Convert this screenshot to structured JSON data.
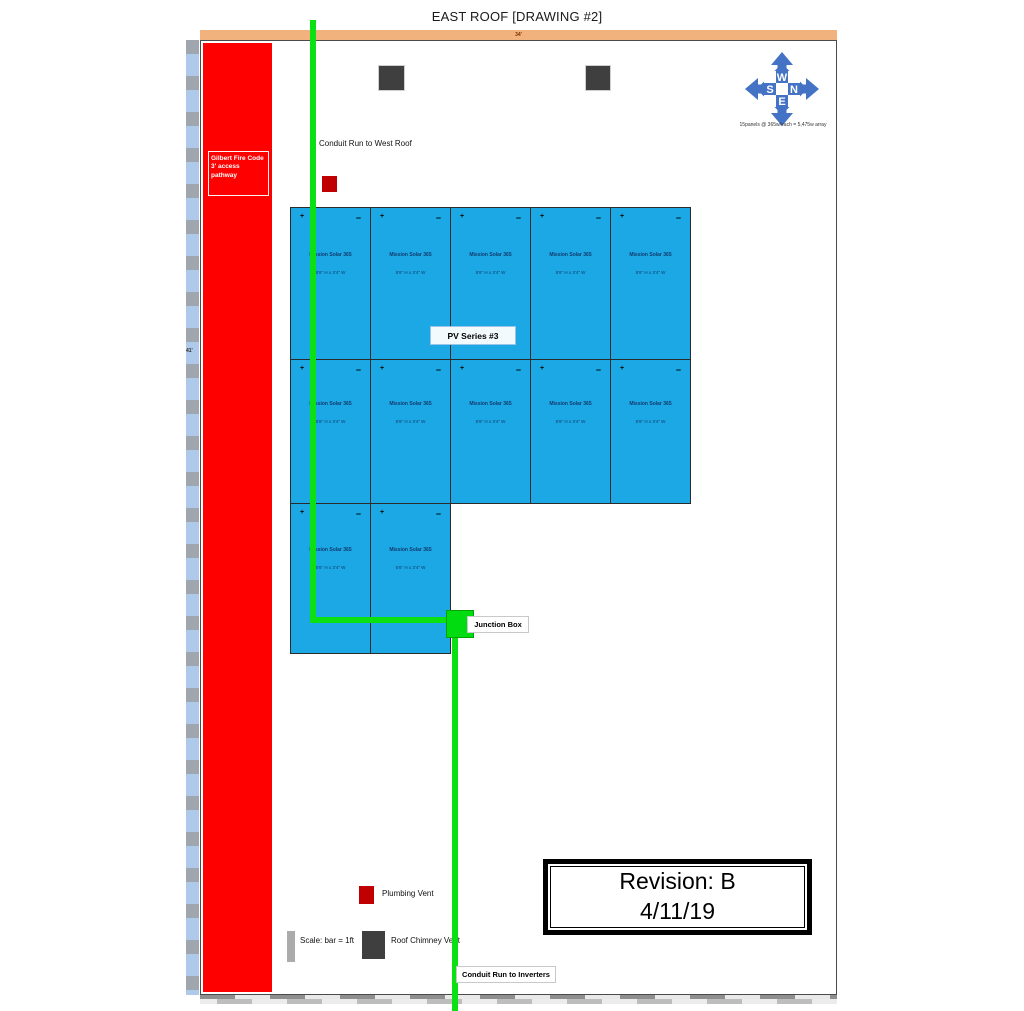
{
  "title": "EAST ROOF [DRAWING #2]",
  "dimensions": {
    "top_width": "34'",
    "left_height": "41'"
  },
  "fire_pathway": {
    "line1": "Gilbert Fire Code",
    "line2": "3' access",
    "line3": "pathway"
  },
  "compass": {
    "top": "W",
    "right": "N",
    "bottom": "E",
    "left": "S",
    "caption": "15panels @ 365w/each = 5,475w array",
    "color": "#4472C4"
  },
  "panels": {
    "rows": [
      5,
      5,
      2
    ],
    "plus": "+",
    "minus": "−",
    "name": "Mission Solar 365",
    "size": "5'6\" H x 3'4\" W",
    "fill_color": "#1BA8E5",
    "series_label": "PV Series #3"
  },
  "labels": {
    "conduit_west": "Conduit Run to West Roof",
    "junction_box": "Junction Box",
    "conduit_inverters": "Conduit Run to Inverters"
  },
  "legend": {
    "plumbing_vent": "Plumbing Vent",
    "scale": "Scale: bar = 1ft",
    "roof_chimney_vent": "Roof Chimney Vent"
  },
  "revision": {
    "line1": "Revision: B",
    "line2": "4/11/19"
  },
  "colors": {
    "pathway_red": "#FF0000",
    "vent_red": "#C00000",
    "conduit_green": "#0BE112",
    "chimney_gray": "#3F3F3F",
    "dimension_orange": "#F2B27E",
    "ruler_blue": "#AEC9EA"
  }
}
